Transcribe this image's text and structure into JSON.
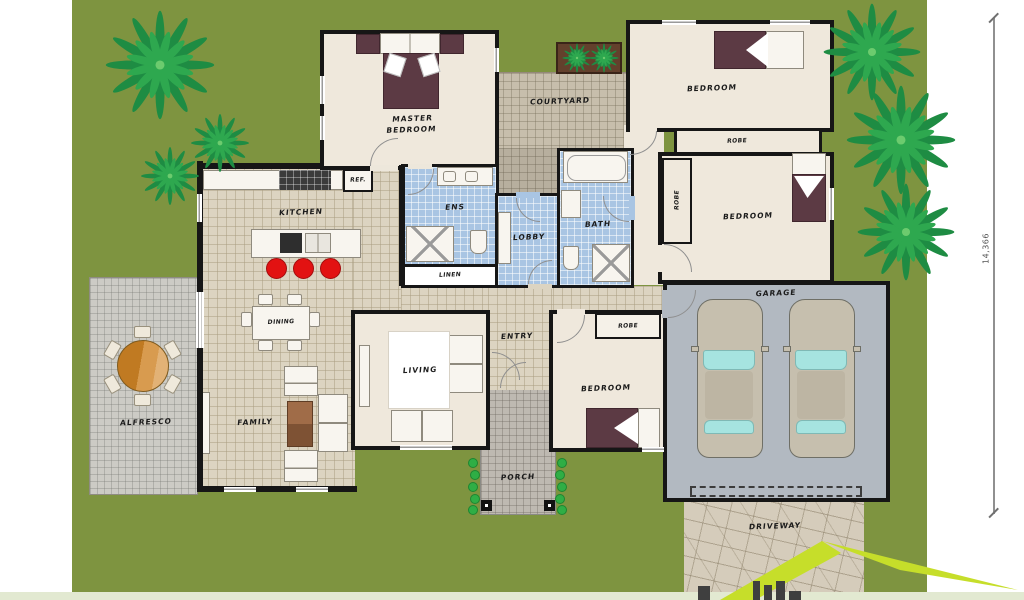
{
  "scene": {
    "dimension_label": "14,366",
    "labels": {
      "master_bedroom": "MASTER BEDROOM",
      "kitchen": "KITCHEN",
      "ref": "REF.",
      "ens": "ENS",
      "linen": "LINEN",
      "lobby": "LOBBY",
      "bath": "BATH",
      "courtyard": "COURTYARD",
      "bedroom_top": "BEDROOM",
      "robe_top": "ROBE",
      "bedroom_right": "BEDROOM",
      "robe_right": "ROBE",
      "bedroom_front": "BEDROOM",
      "robe_front": "ROBE",
      "garage": "GARAGE",
      "driveway": "DRIVEWAY",
      "entry": "ENTRY",
      "porch": "PORCH",
      "dining": "DINING",
      "family": "FAMILY",
      "living": "LIVING",
      "alfresco": "ALFRESCO"
    },
    "colors": {
      "grass": "#7E9440",
      "wall": "#161616",
      "floor_cream": "#EFE8DC",
      "floor_tile_beige": "#DCD4C1",
      "wet_tile_blue": "#A9C5E3",
      "garage_floor": "#B2B9C1",
      "bed_maroon": "#5C3A44",
      "stool_red": "#E21212",
      "logo_green": "#C6DE2A"
    }
  }
}
